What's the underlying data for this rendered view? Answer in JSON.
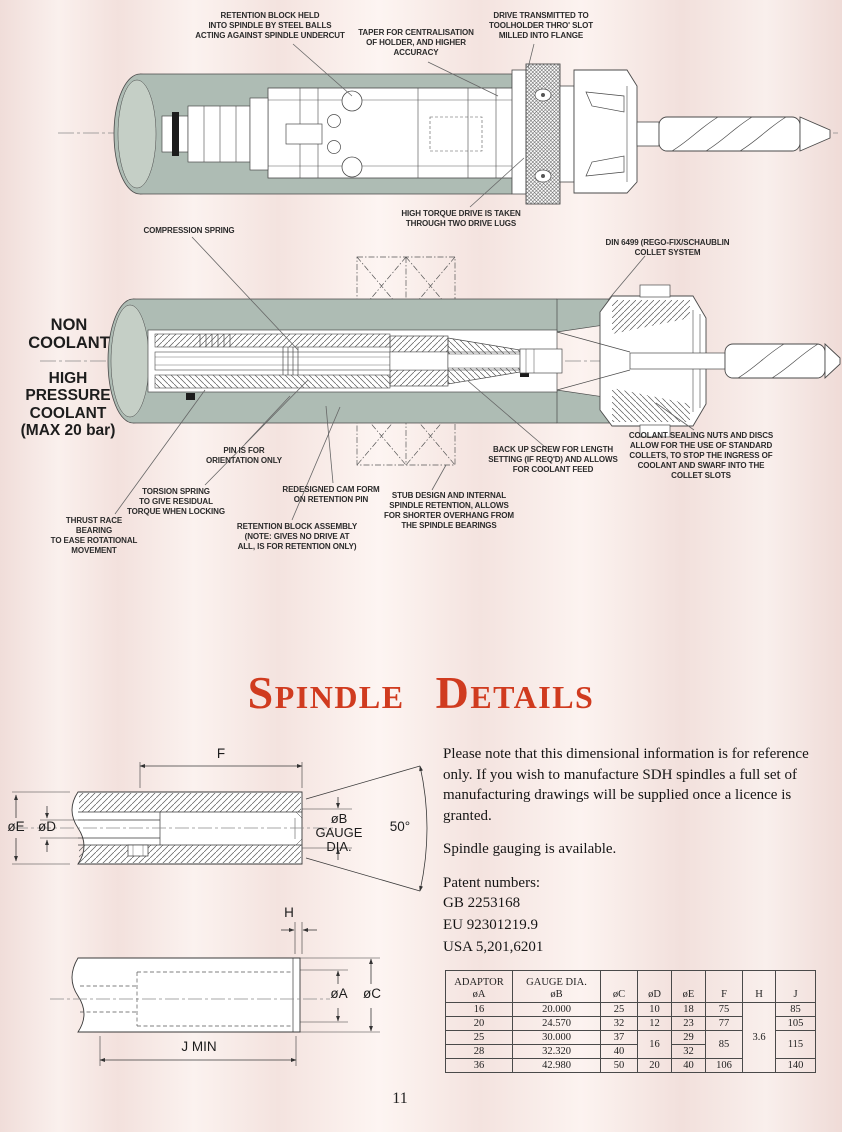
{
  "colors": {
    "title_red": "#d03b1f",
    "housing_gray": "#aebcb4",
    "background_pink": "#f6e8e4"
  },
  "top_diagram": {
    "annotations": {
      "retention_block": "RETENTION BLOCK HELD\nINTO SPINDLE BY STEEL BALLS\nACTING AGAINST SPINDLE UNDERCUT",
      "taper": "TAPER FOR CENTRALISATION\nOF HOLDER, AND HIGHER\nACCURACY",
      "drive": "DRIVE TRANSMITTED TO\nTOOLHOLDER THRO' SLOT\nMILLED INTO FLANGE",
      "high_torque": "HIGH TORQUE DRIVE IS TAKEN\nTHROUGH TWO DRIVE LUGS"
    }
  },
  "middle_diagram": {
    "side_labels": {
      "non_coolant": "NON COOLANT",
      "high_pressure": "HIGH PRESSURE\nCOOLANT\n(MAX 20 bar)"
    },
    "annotations": {
      "compression_spring": "COMPRESSION SPRING",
      "din_collet": "DIN 6499 (REGO-FIX/SCHAUBLIN\nCOLLET SYSTEM",
      "pin_orientation": "PIN IS FOR\nORIENTATION ONLY",
      "torsion_spring": "TORSION SPRING\nTO GIVE RESIDUAL\nTORQUE WHEN LOCKING",
      "thrust_race": "THRUST RACE\nBEARING\nTO EASE ROTATIONAL\nMOVEMENT",
      "cam_form": "REDESIGNED CAM FORM\nON RETENTION PIN",
      "retention_assembly": "RETENTION BLOCK ASSEMBLY\n(NOTE: GIVES NO DRIVE AT\nALL, IS FOR RETENTION ONLY)",
      "stub_design": "STUB DESIGN AND INTERNAL\nSPINDLE RETENTION, ALLOWS\nFOR SHORTER OVERHANG FROM\nTHE SPINDLE BEARINGS",
      "backup_screw": "BACK UP SCREW FOR LENGTH\nSETTING (IF REQ'D) AND ALLOWS\nFOR COOLANT FEED",
      "coolant_sealing": "COOLANT SEALING NUTS AND DISCS\nALLOW FOR THE USE OF STANDARD\nCOLLETS, TO STOP THE INGRESS OF\nCOOLANT AND SWARF INTO THE\nCOLLET SLOTS"
    }
  },
  "section_title": "Spindle Details",
  "info": {
    "paragraph": "Please note that this dimensional information is for reference only. If you wish to manufacture SDH spindles a full set of manufacturing drawings will be supplied once a licence is granted.",
    "gauging": "Spindle gauging is available.",
    "patents_heading": "Patent numbers:",
    "patents": [
      "GB 2253168",
      "EU 92301219.9",
      "USA 5,201,6201"
    ]
  },
  "dimension_labels": {
    "f": "F",
    "oe": "øE",
    "od": "øD",
    "ob_gauge": "øB\nGAUGE\nDIA.",
    "angle": "50°",
    "h": "H",
    "oa": "øA",
    "oc": "øC",
    "j_min": "J MIN"
  },
  "table": {
    "headers": {
      "adaptor": "ADAPTOR",
      "oa": "øA",
      "gauge": "GAUGE DIA.",
      "ob": "øB",
      "oc": "øC",
      "od": "øD",
      "oe": "øE",
      "f": "F",
      "h": "H",
      "j": "J"
    },
    "rows_a": [
      "16",
      "20",
      "25",
      "28",
      "36"
    ],
    "rows_b": [
      "20.000",
      "24.570",
      "30.000",
      "32.320",
      "42.980"
    ],
    "rows_c": [
      "25",
      "32",
      "37",
      "40",
      "50"
    ],
    "d": {
      "r1": "10",
      "r2": "12",
      "r34": "16",
      "r5": "20"
    },
    "rows_e": [
      "18",
      "23",
      "29",
      "32",
      "40"
    ],
    "f": {
      "r1": "75",
      "r2": "77",
      "r34": "85",
      "r5": "106"
    },
    "h_all": "3.6",
    "j": {
      "r1": "85",
      "r2": "105",
      "r34": "115",
      "r5": "140"
    }
  },
  "page_number": "11"
}
